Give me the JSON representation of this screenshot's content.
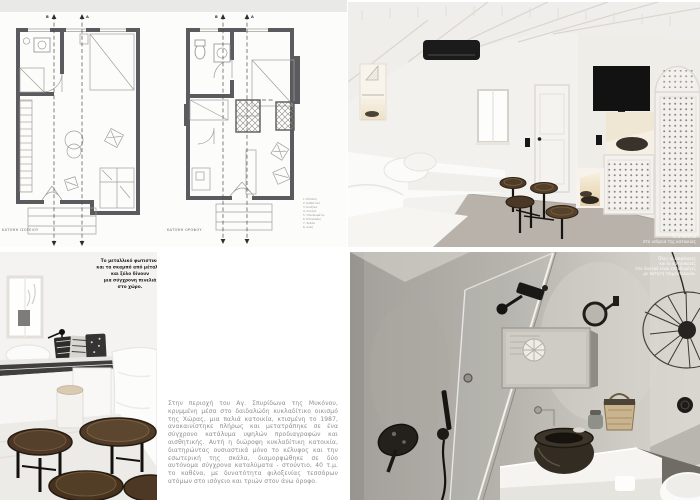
{
  "plans": {
    "ground_floor_label": "ΚΑΤΟΨΗ ΙΣΟΓΕΙΟΥ",
    "upper_floor_label": "ΚΑΤΟΨΗ ΟΡΟΦΟΥ",
    "section_letter_a": "A",
    "section_letter_b": "B",
    "legend_items": [
      "1. Είσοδος",
      "2. Καθιστικό",
      "3. Κουζίνα",
      "4. Λουτρό",
      "5. Υπνοδωμάτιο",
      "6. Ντουλάπες",
      "7. Σκάλα",
      "8. Αυλή"
    ]
  },
  "article": {
    "body_text": "Στην περιοχή του Αγ. Σπυρίδωνα της Μυκόνου, κρυμμένη μέσα στο δαιδαλώδη κυκλαδίτικο οικισμό της Χώρας, μια παλιά κατοικία, κτισμένη το 1987, ανακαινίστηκε πλήρως και μετατράπηκε σε ένα σύγχρονο κατάλυμα υψηλών προδιαγραφών και αισθητικής. Αυτή η διώροφη κυκλαδίτικη κατοικία, διατηρώντας ουσιαστικά μόνο το κέλυφος και την εσωτερική της σκάλα, διαμορφώθηκε σε δύο αυτόνομα σύγχρονα καταλύματα - στούντιο, 40 τ.μ. το καθένα, με δυνατότητα φιλοξενίας τεσσάρων ατόμων στο ισόγειο και τριών στον άνω όροφο."
  },
  "captions": {
    "studio_photo": {
      "lines": [
        "Το στούντιο",
        "στο ισόγειο της κατοικίας"
      ]
    },
    "stools_photo": {
      "lines": [
        "Το μεταλλικό φωτιστικό",
        "και τα σκαμπό από μέταλλο",
        "και ξύλο δίνουν",
        "μια σύγχρονη πινελιά",
        "στο χώρο."
      ]
    },
    "bathroom_photo": {
      "lines": [
        "Όλες οι επιφάνειες",
        "και οι κατασκευές",
        "στο λουτρό είναι επενδυμένες",
        "με πατητή τσιμεντοκονία."
      ]
    }
  },
  "palette": {
    "wood_brown": "#4a3526",
    "cement_grey": "#b3b0ab",
    "floor_grey": "#b8b2ab",
    "fixture_black": "#1b1b1b"
  }
}
